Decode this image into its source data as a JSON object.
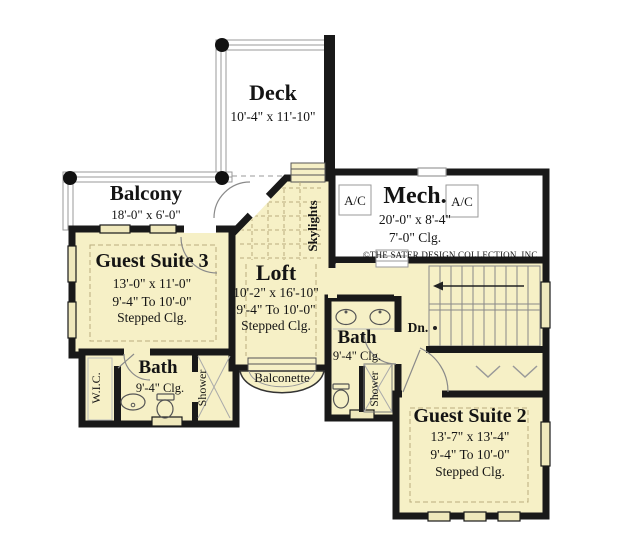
{
  "plan": {
    "title": "Second floor plan",
    "copyright": "©THE SATER DESIGN COLLECTION, INC.",
    "colors": {
      "floor_fill": "#f6f0c6",
      "wall": "#191919",
      "window_fill": "#efe8bc",
      "thin_line": "#8a8a8a",
      "ceiling_dash": "#b9ad7d",
      "background": "#ffffff"
    },
    "rooms": {
      "deck": {
        "name": "Deck",
        "dims": "10'-4\" x 11'-10\""
      },
      "balcony": {
        "name": "Balcony",
        "dims": "18'-0\" x 6'-0\""
      },
      "guest_suite_3": {
        "name": "Guest Suite 3",
        "dims": "13'-0\" x 11'-0\"",
        "ceiling_range": "9'-4\" To 10'-0\"",
        "ceiling_type": "Stepped Clg."
      },
      "loft": {
        "name": "Loft",
        "dims": "10'-2\" x 16'-10\"",
        "ceiling_range": "9'-4\" To 10'-0\"",
        "ceiling_type": "Stepped Clg."
      },
      "mech": {
        "name": "Mech.",
        "dims": "20'-0\" x 8'-4\"",
        "ceiling": "7'-0\" Clg."
      },
      "bath_left": {
        "name": "Bath",
        "ceiling": "9'-4\" Clg."
      },
      "bath_mid": {
        "name": "Bath",
        "ceiling": "9'-4\" Clg."
      },
      "guest_suite_2": {
        "name": "Guest Suite 2",
        "dims": "13'-7\" x 13'-4\"",
        "ceiling_range": "9'-4\" To 10'-0\"",
        "ceiling_type": "Stepped Clg."
      }
    },
    "labels": {
      "wic": "W.I.C.",
      "shower_left": "Shower",
      "shower_mid": "Shower",
      "skylights": "Skylights",
      "balconette": "Balconette",
      "down": "Dn.",
      "ac_left": "A/C",
      "ac_right": "A/C"
    }
  }
}
